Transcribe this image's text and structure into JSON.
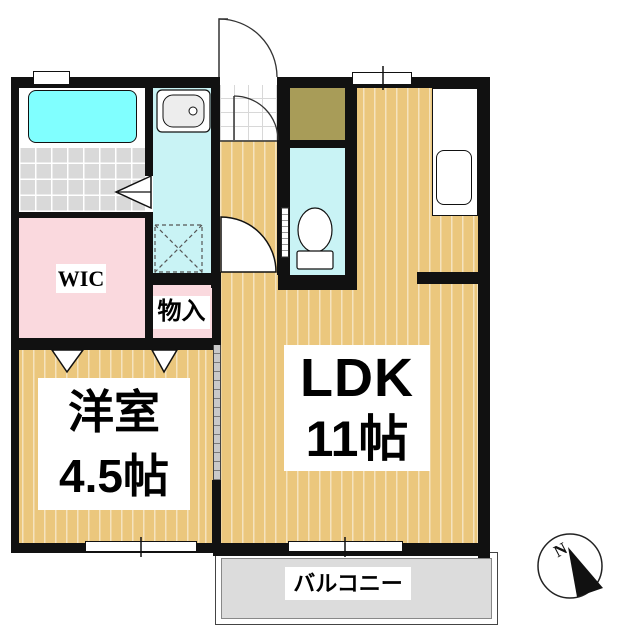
{
  "title": "1LDK Japanese apartment floor plan",
  "rooms": {
    "ldk": {
      "name": "LDK",
      "size": "11帖"
    },
    "western_room": {
      "name": "洋室",
      "size": "4.5帖"
    },
    "wic": {
      "label": "WIC"
    },
    "storage": {
      "label": "物入"
    },
    "balcony": {
      "label": "バルコニー"
    }
  },
  "compass": {
    "label": "N"
  },
  "colors": {
    "wall": "#111111",
    "wood_floor": "#EBC77D",
    "wood_stripe": "#F6E3A9",
    "wet_area_floor": "#C9F3F5",
    "bathtub": "#80FFFF",
    "closet_pink": "#FAD9DE",
    "shoe_closet_olive": "#A89C58",
    "bath_tile": "#D9D9D9",
    "balcony_gray": "#DCDCDC"
  }
}
